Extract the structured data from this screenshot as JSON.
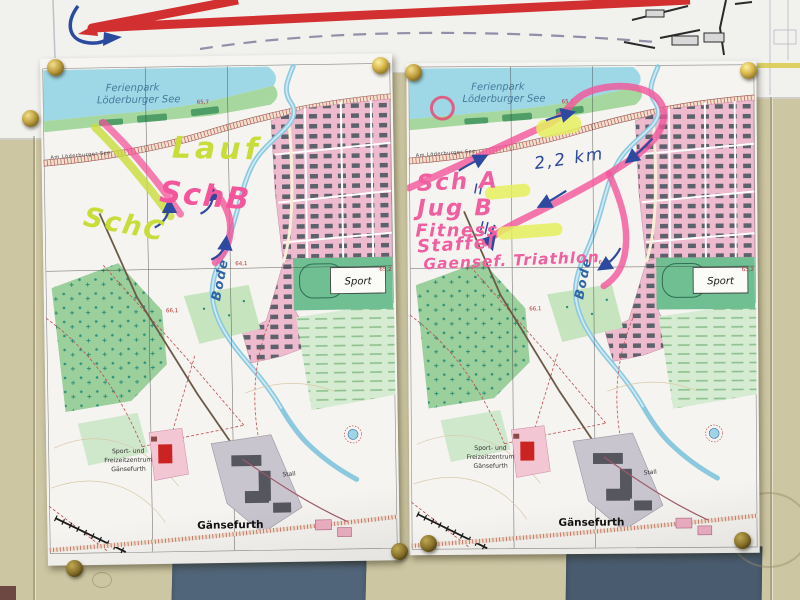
{
  "basemap": {
    "ferienpark_line1": "Ferienpark",
    "ferienpark_line2": "Löderburger See",
    "road_label": "Am Löderburger See",
    "river_label": "Bode",
    "sport_label": "Sport",
    "zentrum_line1": "Sport- und",
    "zentrum_line2": "Freizeitzentrum",
    "zentrum_line3": "Gänsefurth",
    "stall_label": "Stall",
    "town_label": "Gänsefurth",
    "elevations": {
      "e1": "64,1",
      "e2": "65,2",
      "e3": "66,1",
      "e4": "65,7"
    }
  },
  "left_sheet": {
    "annotations": {
      "lauf": "Lauf",
      "sch_b": "SchB",
      "sch_c": "SchC"
    }
  },
  "right_sheet": {
    "annotations": {
      "sch_a": "Sch A",
      "jug_b": "Jug B",
      "fitness": "Fitness",
      "staffel": "Staffel",
      "event": "Gaensef. Triathlon",
      "distance": "2,2 km"
    }
  },
  "icons": {
    "pushpin": "brass-pushpin"
  },
  "colors": {
    "wall": "#cdc6a2",
    "panel_slate": "#4d6076",
    "route_pink": "#f4559b",
    "route_green": "#c9dd3a",
    "ink_blue": "#2d4a9e",
    "highlight_yellow": "#e6f05e",
    "town_pink": "#eebacd",
    "water_blue": "#9ed7e6",
    "pin_gold": "#c0a040"
  }
}
